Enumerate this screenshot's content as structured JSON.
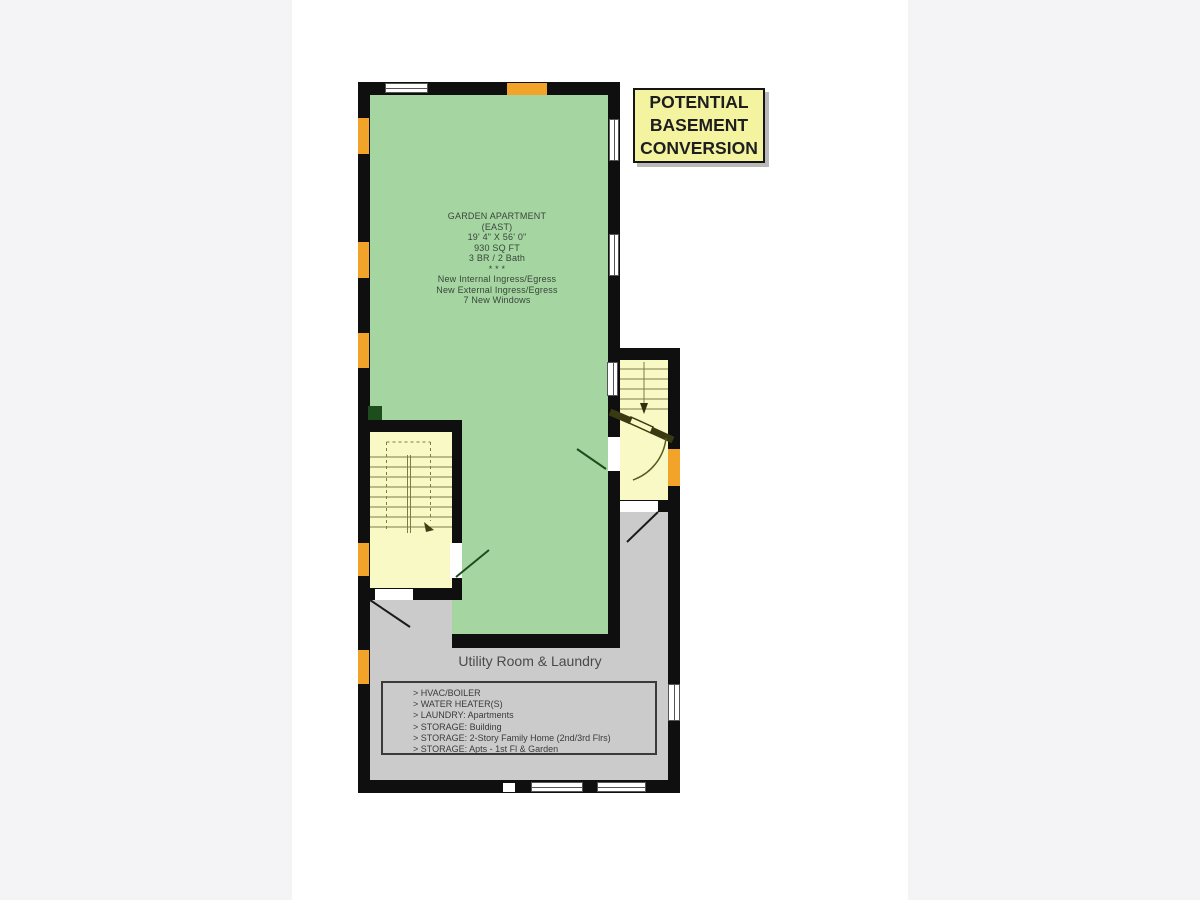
{
  "title_box": {
    "lines": [
      "POTENTIAL",
      "BASEMENT",
      "CONVERSION"
    ],
    "bg_color": "#f4f4a0"
  },
  "garden_apartment": {
    "lines": [
      "GARDEN APARTMENT",
      "(EAST)",
      "19' 4\" X 56' 0\"",
      "930 SQ FT",
      "3 BR / 2 Bath",
      "* * *",
      "New Internal Ingress/Egress",
      "New External Ingress/Egress",
      "7 New Windows"
    ],
    "fill_color": "#a5d6a2"
  },
  "utility_room": {
    "label": "Utility Room & Laundry",
    "notes": [
      "> HVAC/BOILER",
      "> WATER HEATER(S)",
      "> LAUNDRY:  Apartments",
      "> STORAGE:  Building",
      "> STORAGE:  2-Story Family Home (2nd/3rd Flrs)",
      "> STORAGE:  Apts - 1st Fl & Garden"
    ],
    "fill_color": "#cbcbcb"
  },
  "stairwells": {
    "fill_color": "#f9f9c6",
    "left_direction": "down",
    "right_direction": "down"
  },
  "colors": {
    "wall": "#0f0f0f",
    "window_marker_orange": "#f2a32a",
    "door_swing_green": "#1d4d1d",
    "stair_line_olive": "#7d7d49",
    "page_gutter": "#f4f4f6"
  }
}
